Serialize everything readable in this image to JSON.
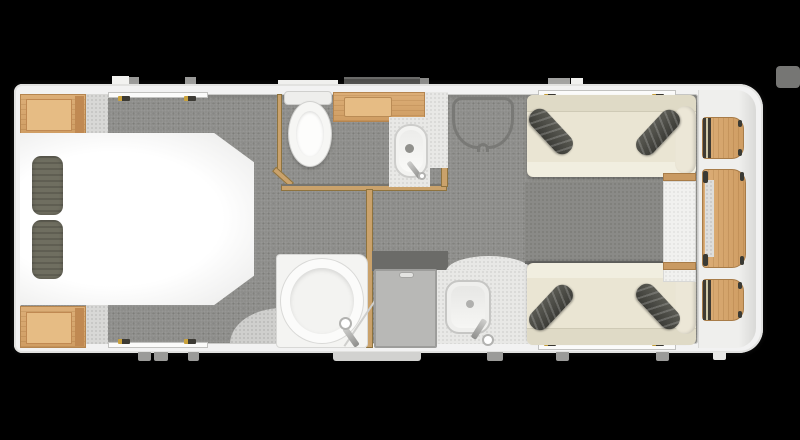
{
  "scene": {
    "title": "Caravan floor plan (top-down render)",
    "background_color": "#000000"
  },
  "palette": {
    "wall_white": "#f2f2f2",
    "carpet_grey": "#8e8e8b",
    "floor_speckle": "#d8d8d6",
    "counter_speckle": "#e8e8e6",
    "wood_light_oak": "#d9a76e",
    "wood_trim": "#c99a62",
    "sofa_cream": "#eae5d3",
    "cushion_dark_grey": "#4a4a44",
    "pillow_grey": "#6f6e60",
    "fixture_white": "#f6f6f4",
    "door_grey": "#b8b8b6",
    "step_dark_grey": "#585856"
  },
  "rooms": {
    "bedroom": {
      "name": "rear-bedroom",
      "furniture": [
        "island-bed",
        "pillow x2",
        "bedside-wardrobe x2"
      ]
    },
    "washroom": {
      "name": "washroom",
      "furniture": [
        "toilet",
        "oak-vanity-counter",
        "washbasin",
        "basin-tap"
      ]
    },
    "shower_room": {
      "name": "shower-cubicle",
      "furniture": [
        "circular-shower-tray",
        "shower-mixer"
      ]
    },
    "entrance": {
      "name": "entrance",
      "furniture": [
        "entry-door",
        "door-handle",
        "entry-step"
      ]
    },
    "kitchen": {
      "name": "kitchen",
      "furniture": [
        "curved-worktop",
        "sink-bowl",
        "mixer-tap"
      ]
    },
    "lounge": {
      "name": "front-lounge",
      "furniture": [
        "sofa x2",
        "bolster-cushion x4",
        "front-cabinet",
        "occasional-table x3",
        "rug"
      ]
    },
    "hall": {
      "name": "corridor",
      "furniture": [
        "dresser-unit-outline"
      ]
    }
  },
  "exterior": {
    "features": [
      "window-latch-blocks",
      "rooflight",
      "entry-step",
      "corner-steadies"
    ]
  }
}
